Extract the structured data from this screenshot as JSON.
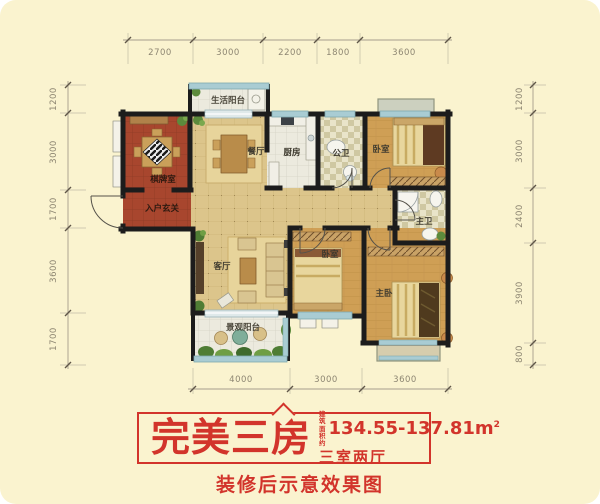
{
  "colors": {
    "background": "#faf3cf",
    "wall": "#1c1c1c",
    "banner_red": "#d2342b",
    "dim_text": "#8d8672",
    "window_blue": "#a9ccd3"
  },
  "plan": {
    "rooms": {
      "service_balcony": "生活阳台",
      "dining": "餐厅",
      "kitchen": "厨房",
      "guest_bath": "公卫",
      "bedroom_top": "卧室",
      "chess_room": "棋牌室",
      "entry": "入户玄关",
      "master_bath": "主卫",
      "living": "客厅",
      "bedroom_mid": "卧室",
      "master_bedroom": "主卧",
      "view_balcony": "景观阳台"
    },
    "dims": {
      "top": [
        "2700",
        "3000",
        "2200",
        "1800",
        "3600"
      ],
      "left": [
        "1200",
        "3000",
        "1700",
        "3600",
        "1700"
      ],
      "right": [
        "1200",
        "3000",
        "2400",
        "3900",
        "800"
      ],
      "bottom": [
        "4000",
        "3000",
        "3600"
      ]
    }
  },
  "banner": {
    "title": "完美三房",
    "area_label_top": "建筑",
    "area_label_bottom": "面积约",
    "area_value": "134.55-137.81m",
    "area_exponent": "2",
    "layout_type": "三室两厅",
    "caption": "装修后示意效果图"
  }
}
